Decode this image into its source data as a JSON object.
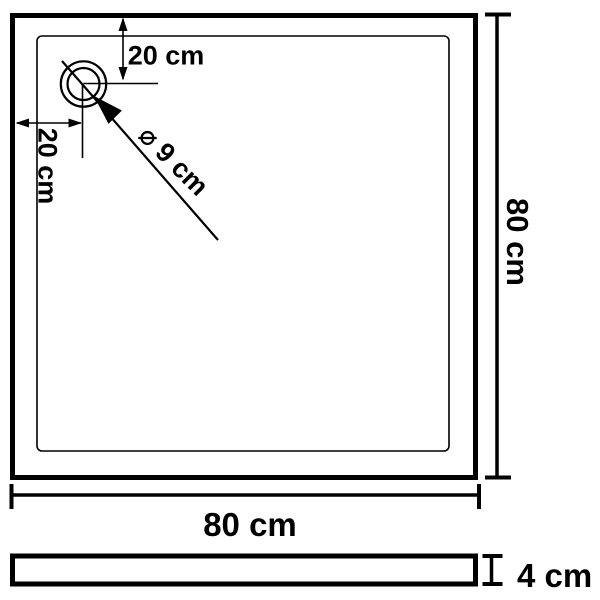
{
  "diagram": {
    "colors": {
      "line": "#000000",
      "background": "#ffffff"
    },
    "top_view": {
      "width_label": "80 cm",
      "height_label": "80 cm",
      "drain": {
        "offset_from_top_label": "20 cm",
        "offset_from_left_label": "20 cm",
        "diameter_label": "⌀ 9 cm"
      }
    },
    "side_view": {
      "thickness_label": "4 cm"
    }
  }
}
